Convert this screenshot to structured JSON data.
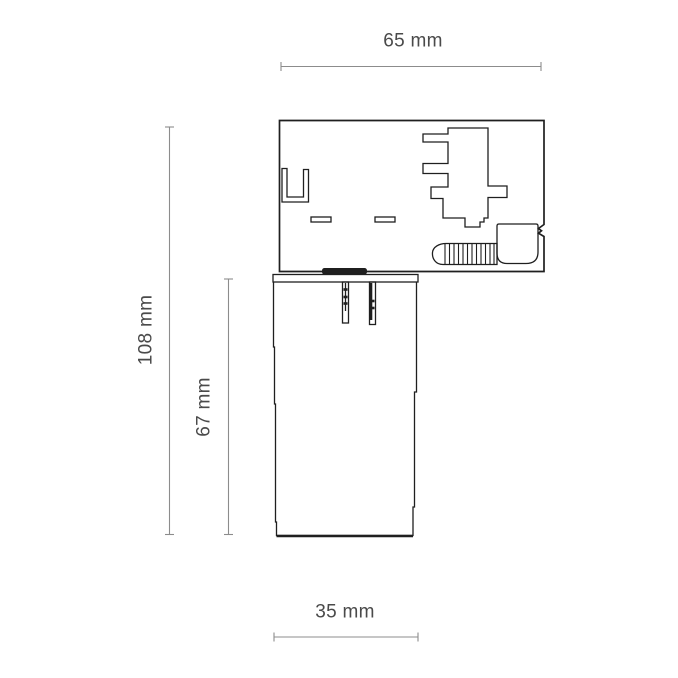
{
  "diagram": {
    "name": "Track light adapter dimension drawing",
    "labels": {
      "width_top": "65 mm",
      "height_total": "108 mm",
      "height_body": "67 mm",
      "width_bottom": "35 mm"
    },
    "colors": {
      "outline": "#1f1f1f",
      "dimension_line": "#8c8c8c",
      "label_text": "#4a4a4a",
      "background": "#ffffff"
    }
  }
}
